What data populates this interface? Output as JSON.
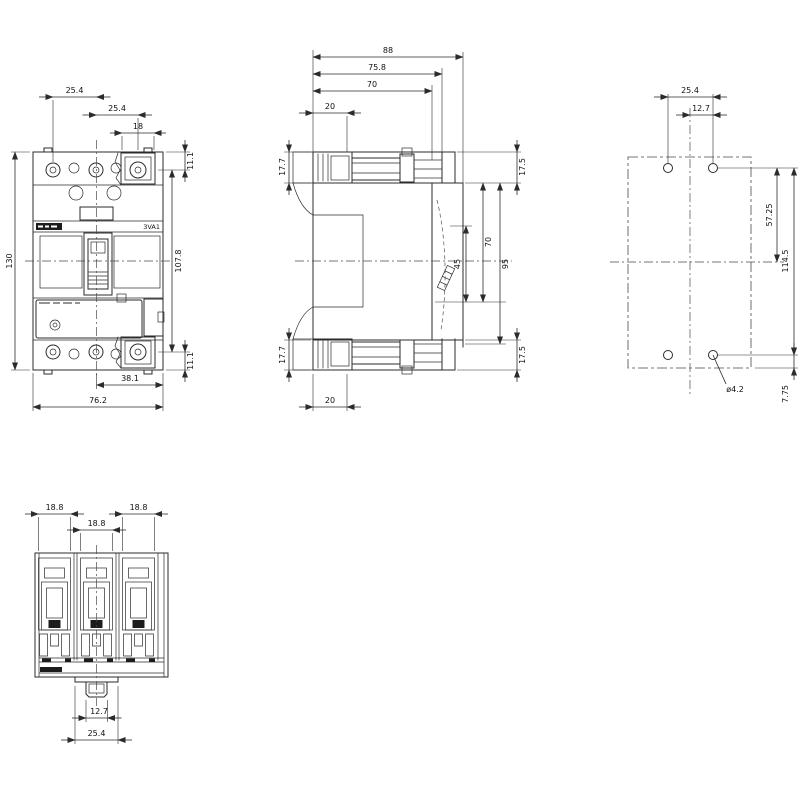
{
  "drawing": {
    "product_label": "3VA1",
    "front_view": {
      "dims": {
        "pole_pitch_1": "25.4",
        "pole_pitch_2": "25.4",
        "terminal_width": "18",
        "top_terminal_offset": "11.1",
        "bottom_terminal_offset": "11.1",
        "overall_height": "130",
        "inner_height": "107.8",
        "half_width": "38.1",
        "overall_width": "76.2"
      }
    },
    "side_view": {
      "dims": {
        "overall_depth": "88",
        "depth_to_rail": "75.8",
        "body_depth": "70",
        "terminal_depth_top": "20",
        "terminal_height_top": "17.7",
        "terminal_height_bottom": "17.7",
        "front_height_top": "17.5",
        "front_height_bottom": "17.5",
        "mount_span": "70",
        "mount_offset": "45",
        "rear_span": "95",
        "terminal_depth_bottom": "20"
      }
    },
    "drilling_view": {
      "dims": {
        "hole_pitch": "25.4",
        "hole_half_pitch": "12.7",
        "half_height": "57.25",
        "hole_row_span": "114.5",
        "bottom_edge_offset": "7.75",
        "hole_diameter": "ø4.2"
      }
    },
    "bottom_view": {
      "dims": {
        "terminal_opening_1": "18.8",
        "terminal_opening_2": "18.8",
        "terminal_opening_3": "18.8",
        "clip_width": "12.7",
        "clip_span": "25.4"
      }
    }
  }
}
